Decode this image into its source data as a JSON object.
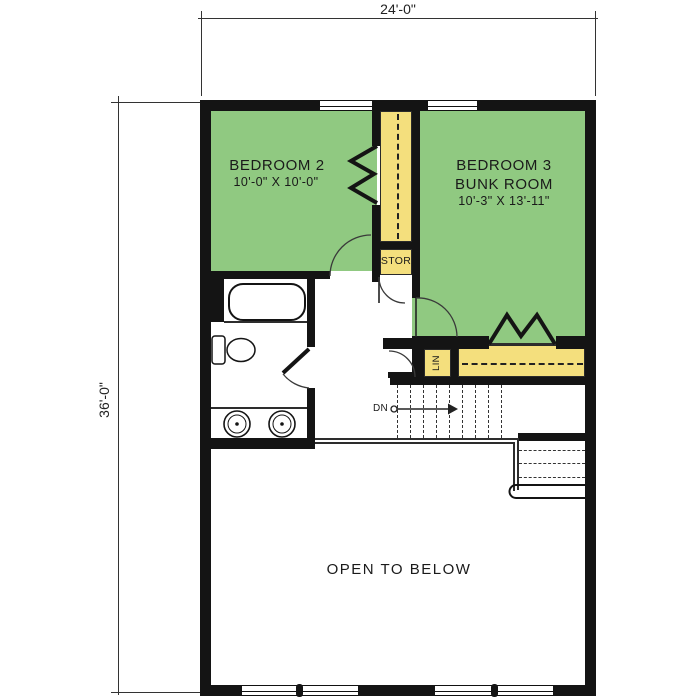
{
  "plan": {
    "title": "Second floor plan",
    "dimensions": {
      "width_label": "24'-0\"",
      "height_label": "36'-0\""
    },
    "rooms": {
      "bedroom2": {
        "name": "BEDROOM 2",
        "size": "10'-0\" X 10'-0\""
      },
      "bedroom3": {
        "name": "BEDROOM 3",
        "subtitle": "BUNK ROOM",
        "size": "10'-3\" X 13'-11\""
      },
      "storage_closet": {
        "name": "STOR"
      },
      "linen_closet": {
        "name": "LIN"
      },
      "open_to_below": {
        "name": "OPEN TO BELOW"
      },
      "stairs": {
        "direction_label": "DN"
      }
    },
    "colors": {
      "wall": "#141414",
      "room_fill": "#90c981",
      "closet_fill": "#f4df7d"
    }
  }
}
